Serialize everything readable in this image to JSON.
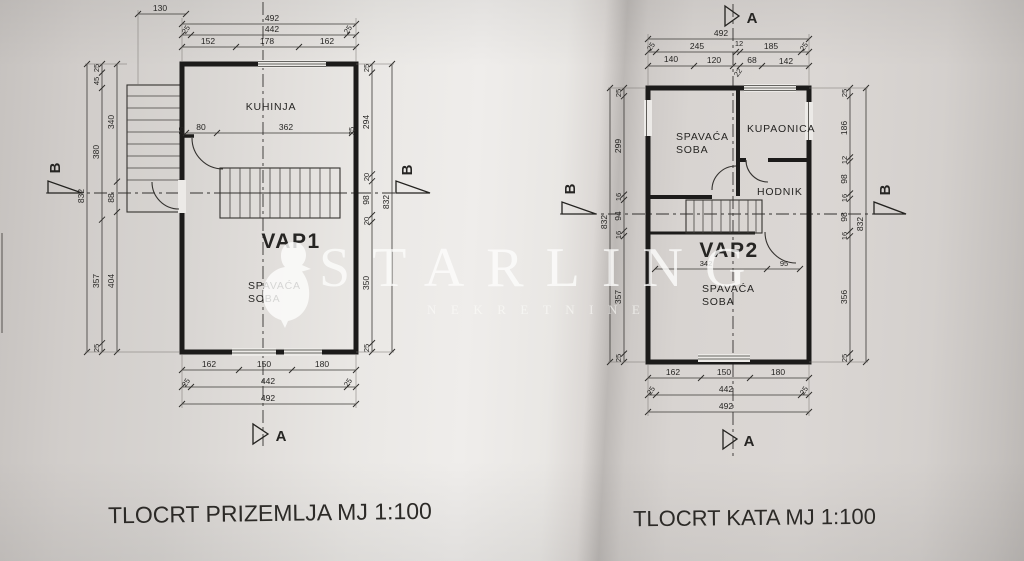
{
  "photo": {
    "caption_left": "TLOCRT PRIZEMLJA MJ 1:100",
    "caption_right": "TLOCRT KATA MJ 1:100"
  },
  "watermark": {
    "brand": "STARLING",
    "tagline": "NEKRETNINE"
  },
  "ground": {
    "rooms": {
      "kitchen": "KUHINJA",
      "unit": "VAP1",
      "bedroom1": "SPAVAĆA",
      "bedroom2": "SOBA"
    },
    "markers": {
      "a": "A",
      "b": "B"
    },
    "dim": {
      "stair_width": "130",
      "top_total": "492",
      "top_mid_l": "25",
      "top_mid_c": "442",
      "top_mid_r": "25",
      "top_in_1": "152",
      "top_in_2": "178",
      "top_in_3": "162",
      "int_wall_l": "25",
      "int_1": "80",
      "int_2": "362",
      "int_wall_r": "25",
      "left_total": "832",
      "lc_1": "25",
      "lc_2": "45",
      "lc_3": "380",
      "lc_4": "357",
      "lc_5": "25",
      "li_1": "340",
      "li_2": "88",
      "li_3": "404",
      "rc_1": "25",
      "rc_2": "294",
      "rc_3": "20",
      "rc_4": "98",
      "rc_5": "20",
      "rc_6": "350",
      "rc_7": "25",
      "right_total": "832",
      "bot_in_1": "162",
      "bot_in_2": "150",
      "bot_in_3": "180",
      "bot_mid_l": "25",
      "bot_mid_c": "442",
      "bot_mid_r": "25",
      "bot_total": "492"
    }
  },
  "upper": {
    "rooms": {
      "bedroom_a1": "SPAVAĆA",
      "bedroom_a2": "SOBA",
      "bath": "KUPAONICA",
      "hall": "HODNIK",
      "unit": "VAP2",
      "bedroom_b1": "SPAVAĆA",
      "bedroom_b2": "SOBA"
    },
    "markers": {
      "a": "A",
      "b": "B"
    },
    "dim": {
      "top_total": "492",
      "tm_1": "25",
      "tm_2": "245",
      "tm_3": "12",
      "tm_4": "185",
      "tm_5": "25",
      "ti_1": "140",
      "ti_2": "120",
      "ti_3": "22",
      "ti_4": "68",
      "ti_5": "142",
      "int_1": "342",
      "int_2": "95",
      "left_total": "832",
      "lc_1": "25",
      "lc_2": "299",
      "lc_3": "16",
      "lc_4": "94",
      "lc_5": "16",
      "lc_6": "357",
      "lc_7": "25",
      "rc_1": "25",
      "rc_2": "186",
      "rc_3": "12",
      "rc_4": "98",
      "rc_5": "16",
      "rc_6": "98",
      "rc_7": "16",
      "rc_8": "356",
      "rc_9": "25",
      "right_total": "832",
      "bot_in_1": "162",
      "bot_in_2": "150",
      "bot_in_3": "180",
      "bot_mid_l": "25",
      "bot_mid_c": "442",
      "bot_mid_r": "25",
      "bot_total": "492"
    }
  }
}
